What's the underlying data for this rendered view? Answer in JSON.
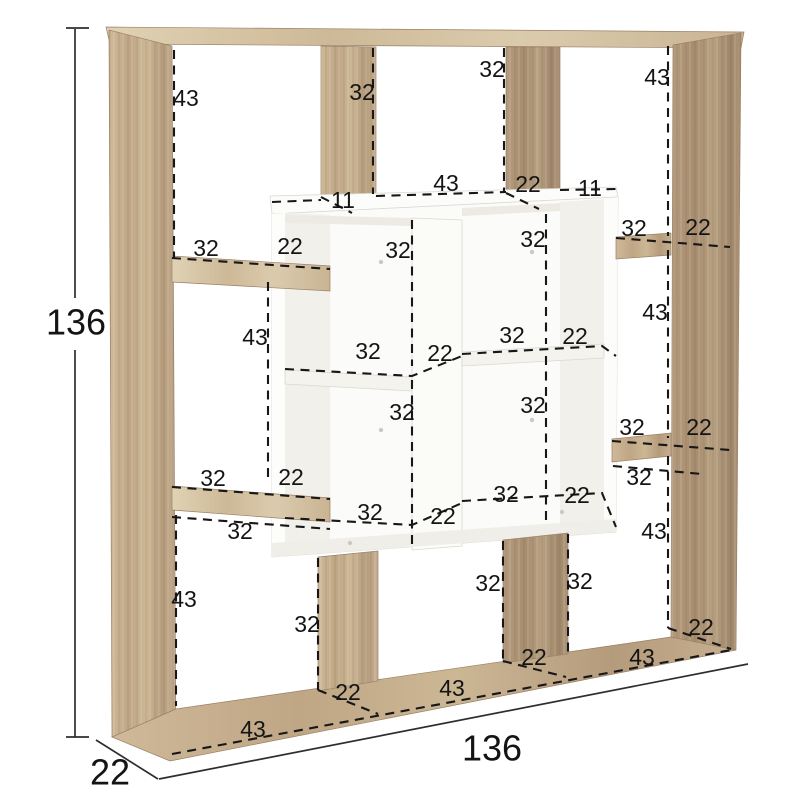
{
  "page": {
    "type": "furniture dimension diagram",
    "subject": "asymmetric cube bookcase, oak frame with white center cube insert",
    "background": "#ffffff"
  },
  "colors": {
    "wood_light": "#d8c8aa",
    "wood_mid": "#c6af90",
    "wood_dark": "#ad9477",
    "white_panel": "#fafaf8",
    "dimension_line": "#171717"
  },
  "overall_dimensions": [
    {
      "name": "overall-height",
      "value": "136",
      "x": 76,
      "y": 322
    },
    {
      "name": "overall-width",
      "value": "136",
      "x": 492,
      "y": 748
    },
    {
      "name": "overall-depth",
      "value": "22",
      "x": 110,
      "y": 772
    }
  ],
  "dimension_labels": [
    {
      "value": "43",
      "x": 186,
      "y": 98
    },
    {
      "value": "32",
      "x": 362,
      "y": 92
    },
    {
      "value": "32",
      "x": 492,
      "y": 69
    },
    {
      "value": "43",
      "x": 657,
      "y": 77
    },
    {
      "value": "11",
      "x": 343,
      "y": 200
    },
    {
      "value": "43",
      "x": 446,
      "y": 183
    },
    {
      "value": "22",
      "x": 528,
      "y": 184
    },
    {
      "value": "11",
      "x": 590,
      "y": 188
    },
    {
      "value": "32",
      "x": 206,
      "y": 248
    },
    {
      "value": "22",
      "x": 290,
      "y": 246
    },
    {
      "value": "43",
      "x": 255,
      "y": 337
    },
    {
      "value": "32",
      "x": 213,
      "y": 478
    },
    {
      "value": "22",
      "x": 291,
      "y": 477
    },
    {
      "value": "32",
      "x": 240,
      "y": 531
    },
    {
      "value": "43",
      "x": 184,
      "y": 599
    },
    {
      "value": "32",
      "x": 634,
      "y": 228
    },
    {
      "value": "22",
      "x": 698,
      "y": 227
    },
    {
      "value": "43",
      "x": 655,
      "y": 312
    },
    {
      "value": "32",
      "x": 632,
      "y": 427
    },
    {
      "value": "22",
      "x": 699,
      "y": 427
    },
    {
      "value": "32",
      "x": 639,
      "y": 477
    },
    {
      "value": "43",
      "x": 654,
      "y": 531
    },
    {
      "value": "22",
      "x": 701,
      "y": 627
    },
    {
      "value": "32",
      "x": 398,
      "y": 250
    },
    {
      "value": "32",
      "x": 533,
      "y": 239
    },
    {
      "value": "32",
      "x": 368,
      "y": 351
    },
    {
      "value": "22",
      "x": 440,
      "y": 353
    },
    {
      "value": "32",
      "x": 512,
      "y": 335
    },
    {
      "value": "22",
      "x": 575,
      "y": 336
    },
    {
      "value": "32",
      "x": 402,
      "y": 412
    },
    {
      "value": "32",
      "x": 533,
      "y": 405
    },
    {
      "value": "32",
      "x": 370,
      "y": 512
    },
    {
      "value": "22",
      "x": 443,
      "y": 516
    },
    {
      "value": "32",
      "x": 506,
      "y": 494
    },
    {
      "value": "22",
      "x": 577,
      "y": 495
    },
    {
      "value": "32",
      "x": 307,
      "y": 624
    },
    {
      "value": "22",
      "x": 348,
      "y": 692
    },
    {
      "value": "43",
      "x": 253,
      "y": 729
    },
    {
      "value": "32",
      "x": 488,
      "y": 583
    },
    {
      "value": "32",
      "x": 580,
      "y": 581
    },
    {
      "value": "22",
      "x": 534,
      "y": 657
    },
    {
      "value": "43",
      "x": 452,
      "y": 688
    },
    {
      "value": "43",
      "x": 642,
      "y": 657
    }
  ]
}
